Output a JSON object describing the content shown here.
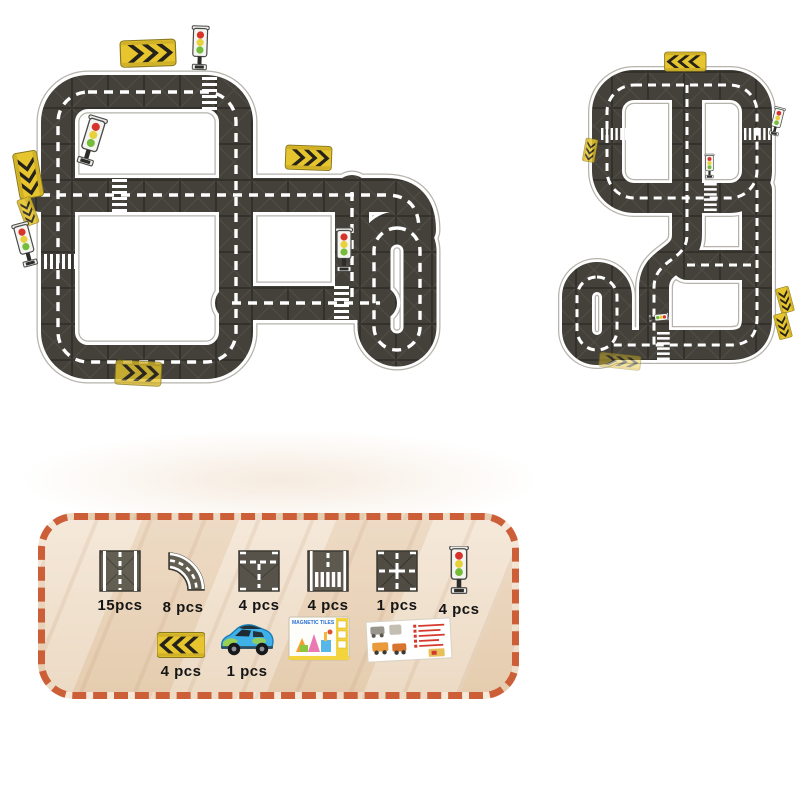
{
  "panel": {
    "border_color": "#cd5f38",
    "box_title": "MAGNETIC TILES",
    "row1": [
      {
        "icon": "straight-road-tile-icon",
        "count": "15pcs"
      },
      {
        "icon": "curved-road-tile-icon",
        "count": "8 pcs"
      },
      {
        "icon": "t-junction-tile-icon",
        "count": "4 pcs"
      },
      {
        "icon": "crosswalk-tile-icon",
        "count": "4 pcs"
      },
      {
        "icon": "cross-junction-tile-icon",
        "count": "1 pcs"
      },
      {
        "icon": "traffic-light-icon",
        "count": "4 pcs"
      }
    ],
    "row2": [
      {
        "icon": "chevron-sign-icon",
        "count": "4 pcs"
      },
      {
        "icon": "toy-car-icon",
        "count": "1 pcs"
      },
      {
        "icon": "product-box-icon",
        "count": ""
      },
      {
        "icon": "instruction-sheet-icon",
        "count": ""
      }
    ]
  }
}
